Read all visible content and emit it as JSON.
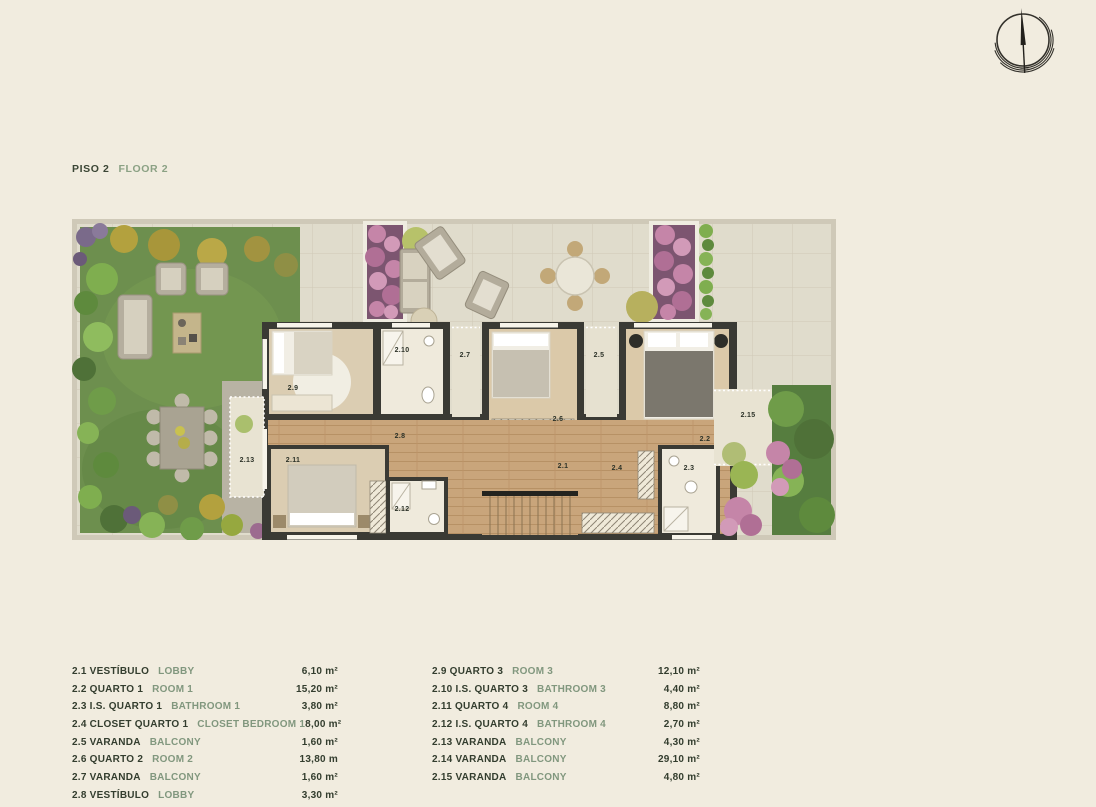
{
  "theme": {
    "background": "#f1ecdf",
    "title_primary": "#3a4534",
    "title_secondary": "#8ba184",
    "legend_primary": "#333d2e",
    "legend_secondary": "#81977e",
    "plan_wall": "#3a3a34",
    "plan_grass": "#6d8f4e",
    "plan_wood": "#c9a57b",
    "plan_stone": "#e0dccc",
    "plan_flowers": "#c585a8"
  },
  "header": {
    "floor_label_pt": "PISO 2",
    "floor_label_en": "FLOOR 2"
  },
  "compass": {
    "icon": "compass-north-icon"
  },
  "plan": {
    "room_labels": [
      "2.1",
      "2.2",
      "2.3",
      "2.4",
      "2.5",
      "2.6",
      "2.7",
      "2.8",
      "2.9",
      "2.10",
      "2.11",
      "2.12",
      "2.13",
      "2.15"
    ]
  },
  "legend": {
    "left": [
      {
        "pt": "2.1 VESTÍBULO",
        "en": "LOBBY",
        "area": "6,10 m²"
      },
      {
        "pt": "2.2 QUARTO 1",
        "en": "ROOM 1",
        "area": "15,20 m²"
      },
      {
        "pt": "2.3 I.S. QUARTO 1",
        "en": "BATHROOM 1",
        "area": "3,80 m²"
      },
      {
        "pt": "2.4 CLOSET QUARTO 1",
        "en": "CLOSET BEDROOM 1",
        "area": "8,00 m²"
      },
      {
        "pt": "2.5 VARANDA",
        "en": "BALCONY",
        "area": "1,60 m²"
      },
      {
        "pt": "2.6 QUARTO 2",
        "en": "ROOM 2",
        "area": "13,80 m"
      },
      {
        "pt": "2.7 VARANDA",
        "en": "BALCONY",
        "area": "1,60 m²"
      },
      {
        "pt": "2.8 VESTÍBULO",
        "en": "LOBBY",
        "area": "3,30 m²"
      }
    ],
    "right": [
      {
        "pt": "2.9 QUARTO 3",
        "en": "ROOM 3",
        "area": "12,10 m²"
      },
      {
        "pt": "2.10 I.S. QUARTO 3",
        "en": "BATHROOM 3",
        "area": "4,40 m²"
      },
      {
        "pt": "2.11 QUARTO 4",
        "en": "ROOM 4",
        "area": "8,80 m²"
      },
      {
        "pt": "2.12 I.S. QUARTO 4",
        "en": "BATHROOM 4",
        "area": "2,70 m²"
      },
      {
        "pt": "2.13 VARANDA",
        "en": "BALCONY",
        "area": "4,30 m²"
      },
      {
        "pt": "2.14 VARANDA",
        "en": "BALCONY",
        "area": "29,10 m²"
      },
      {
        "pt": "2.15 VARANDA",
        "en": "BALCONY",
        "area": "4,80 m²"
      }
    ]
  }
}
